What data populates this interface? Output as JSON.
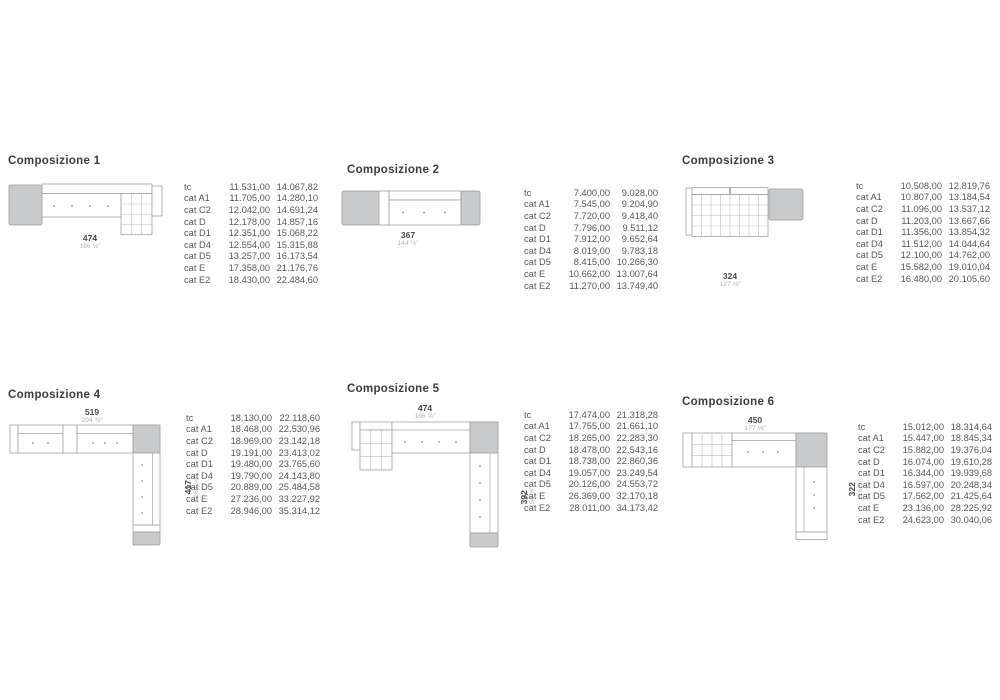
{
  "page": {
    "background": "#ffffff"
  },
  "colors": {
    "title_text": "#3d3d3f",
    "table_text": "#57575b",
    "sofa_outline": "#a3a3a5",
    "sofa_gray_fill": "#c9cacb",
    "dim_number": "#48484a",
    "dim_inches": "#b5b5b7"
  },
  "compositions": [
    {
      "title": "Composizione 1",
      "dim_width": {
        "cm": "474",
        "inches": "186 ⅝″"
      },
      "rows": [
        {
          "label": "tc",
          "price1": "11.531,00",
          "price2": "14.067,82"
        },
        {
          "label": "cat A1",
          "price1": "11.705,00",
          "price2": "14.280,10"
        },
        {
          "label": "cat C2",
          "price1": "12.042,00",
          "price2": "14.691,24"
        },
        {
          "label": "cat D",
          "price1": "12.178,00",
          "price2": "14.857,16"
        },
        {
          "label": "cat D1",
          "price1": "12.351,00",
          "price2": "15.068,22"
        },
        {
          "label": "cat D4",
          "price1": "12.554,00",
          "price2": "15.315,88"
        },
        {
          "label": "cat D5",
          "price1": "13.257,00",
          "price2": "16.173,54"
        },
        {
          "label": "cat E",
          "price1": "17.358,00",
          "price2": "21.176,76"
        },
        {
          "label": "cat E2",
          "price1": "18.430,00",
          "price2": "22.484,60"
        }
      ]
    },
    {
      "title": "Composizione 2",
      "dim_width": {
        "cm": "367",
        "inches": "144 ½″"
      },
      "rows": [
        {
          "label": "tc",
          "price1": "7.400,00",
          "price2": "9.028,00"
        },
        {
          "label": "cat A1",
          "price1": "7.545,00",
          "price2": "9.204,90"
        },
        {
          "label": "cat C2",
          "price1": "7.720,00",
          "price2": "9.418,40"
        },
        {
          "label": "cat D",
          "price1": "7.796,00",
          "price2": "9.511,12"
        },
        {
          "label": "cat D1",
          "price1": "7.912,00",
          "price2": "9.652,64"
        },
        {
          "label": "cat D4",
          "price1": "8.019,00",
          "price2": "9.783,18"
        },
        {
          "label": "cat D5",
          "price1": "8.415,00",
          "price2": "10.266,30"
        },
        {
          "label": "cat E",
          "price1": "10.662,00",
          "price2": "13.007,64"
        },
        {
          "label": "cat E2",
          "price1": "11.270,00",
          "price2": "13.749,40"
        }
      ]
    },
    {
      "title": "Composizione 3",
      "dim_width": {
        "cm": "324",
        "inches": "127 ⅝″"
      },
      "rows": [
        {
          "label": "tc",
          "price1": "10.508,00",
          "price2": "12.819,76"
        },
        {
          "label": "cat A1",
          "price1": "10.807,00",
          "price2": "13.184,54"
        },
        {
          "label": "cat C2",
          "price1": "11.096,00",
          "price2": "13.537,12"
        },
        {
          "label": "cat D",
          "price1": "11.203,00",
          "price2": "13.667,66"
        },
        {
          "label": "cat D1",
          "price1": "11.356,00",
          "price2": "13.854,32"
        },
        {
          "label": "cat D4",
          "price1": "11.512,00",
          "price2": "14.044,64"
        },
        {
          "label": "cat D5",
          "price1": "12.100,00",
          "price2": "14.762,00"
        },
        {
          "label": "cat E",
          "price1": "15.582,00",
          "price2": "19.010,04"
        },
        {
          "label": "cat E2",
          "price1": "16.480,00",
          "price2": "20.105,60"
        }
      ]
    },
    {
      "title": "Composizione 4",
      "dim_width": {
        "cm": "519",
        "inches": "204 ⅜″"
      },
      "dim_depth": {
        "cm": "417",
        "inches": "164 ⅛″"
      },
      "rows": [
        {
          "label": "tc",
          "price1": "18.130,00",
          "price2": "22.118,60"
        },
        {
          "label": "cat A1",
          "price1": "18.468,00",
          "price2": "22.530,96"
        },
        {
          "label": "cat C2",
          "price1": "18.969,00",
          "price2": "23.142,18"
        },
        {
          "label": "cat D",
          "price1": "19.191,00",
          "price2": "23.413,02"
        },
        {
          "label": "cat D1",
          "price1": "19.480,00",
          "price2": "23.765,60"
        },
        {
          "label": "cat D4",
          "price1": "19.790,00",
          "price2": "24.143,80"
        },
        {
          "label": "cat D5",
          "price1": "20.889,00",
          "price2": "25.484,58"
        },
        {
          "label": "cat E",
          "price1": "27.236,00",
          "price2": "33.227,92"
        },
        {
          "label": "cat E2",
          "price1": "28.946,00",
          "price2": "35.314,12"
        }
      ]
    },
    {
      "title": "Composizione 5",
      "dim_width": {
        "cm": "474",
        "inches": "186 ⅝″"
      },
      "dim_depth": {
        "cm": "392",
        "inches": "154 ⅜″"
      },
      "rows": [
        {
          "label": "tc",
          "price1": "17.474,00",
          "price2": "21.318,28"
        },
        {
          "label": "cat A1",
          "price1": "17.755,00",
          "price2": "21.661,10"
        },
        {
          "label": "cat C2",
          "price1": "18.265,00",
          "price2": "22.283,30"
        },
        {
          "label": "cat D",
          "price1": "18.478,00",
          "price2": "22.543,16"
        },
        {
          "label": "cat D1",
          "price1": "18.738,00",
          "price2": "22.860,36"
        },
        {
          "label": "cat D4",
          "price1": "19.057,00",
          "price2": "23.249,54"
        },
        {
          "label": "cat D5",
          "price1": "20.126,00",
          "price2": "24.553,72"
        },
        {
          "label": "cat E",
          "price1": "26.369,00",
          "price2": "32.170,18"
        },
        {
          "label": "cat E2",
          "price1": "28.011,00",
          "price2": "34.173,42"
        }
      ]
    },
    {
      "title": "Composizione 6",
      "dim_width": {
        "cm": "450",
        "inches": "177 ⅛″"
      },
      "dim_depth": {
        "cm": "322",
        "inches": "126 ¾″"
      },
      "rows": [
        {
          "label": "tc",
          "price1": "15.012,00",
          "price2": "18.314,64"
        },
        {
          "label": "cat A1",
          "price1": "15.447,00",
          "price2": "18.845,34"
        },
        {
          "label": "cat C2",
          "price1": "15.882,00",
          "price2": "19.376,04"
        },
        {
          "label": "cat D",
          "price1": "16.074,00",
          "price2": "19.610,28"
        },
        {
          "label": "cat D1",
          "price1": "16.344,00",
          "price2": "19.939,68"
        },
        {
          "label": "cat D4",
          "price1": "16.597,00",
          "price2": "20.248,34"
        },
        {
          "label": "cat D5",
          "price1": "17.562,00",
          "price2": "21.425,64"
        },
        {
          "label": "cat E",
          "price1": "23.136,00",
          "price2": "28.225,92"
        },
        {
          "label": "cat E2",
          "price1": "24.623,00",
          "price2": "30.040,06"
        }
      ]
    }
  ]
}
